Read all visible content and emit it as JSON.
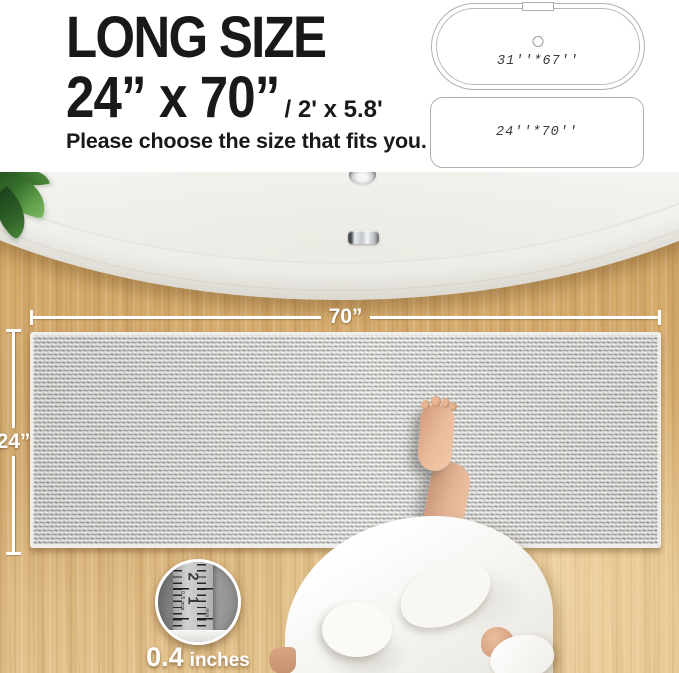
{
  "header": {
    "title": "LONG SIZE",
    "size_main": "24”  x 70”",
    "size_alt": "/ 2' x 5.8'",
    "subtitle": "Please choose the size that fits you."
  },
  "size_diagrams": {
    "tub_label": "31''*67''",
    "mat_label": "24''*70''"
  },
  "dimensions": {
    "width_label": "70”",
    "height_label": "24”"
  },
  "thickness": {
    "value": "0.4",
    "unit": "inches",
    "ruler_number_top": "2",
    "ruler_number_mid": "1",
    "ruler_small_left": "0.5 mm",
    "ruler_small_right": "mm"
  },
  "colors": {
    "text": "#1a1918",
    "floor_wood": "#d9b072",
    "mat_gray": "#c4c4c1",
    "tub_white": "#f9f9f6",
    "leaf_green": "#3a7a33",
    "robe_white": "#f6f5f1",
    "skin": "#e3b294",
    "dimension_line": "#ffffff",
    "diagram_outline": "#b0b0ae"
  }
}
